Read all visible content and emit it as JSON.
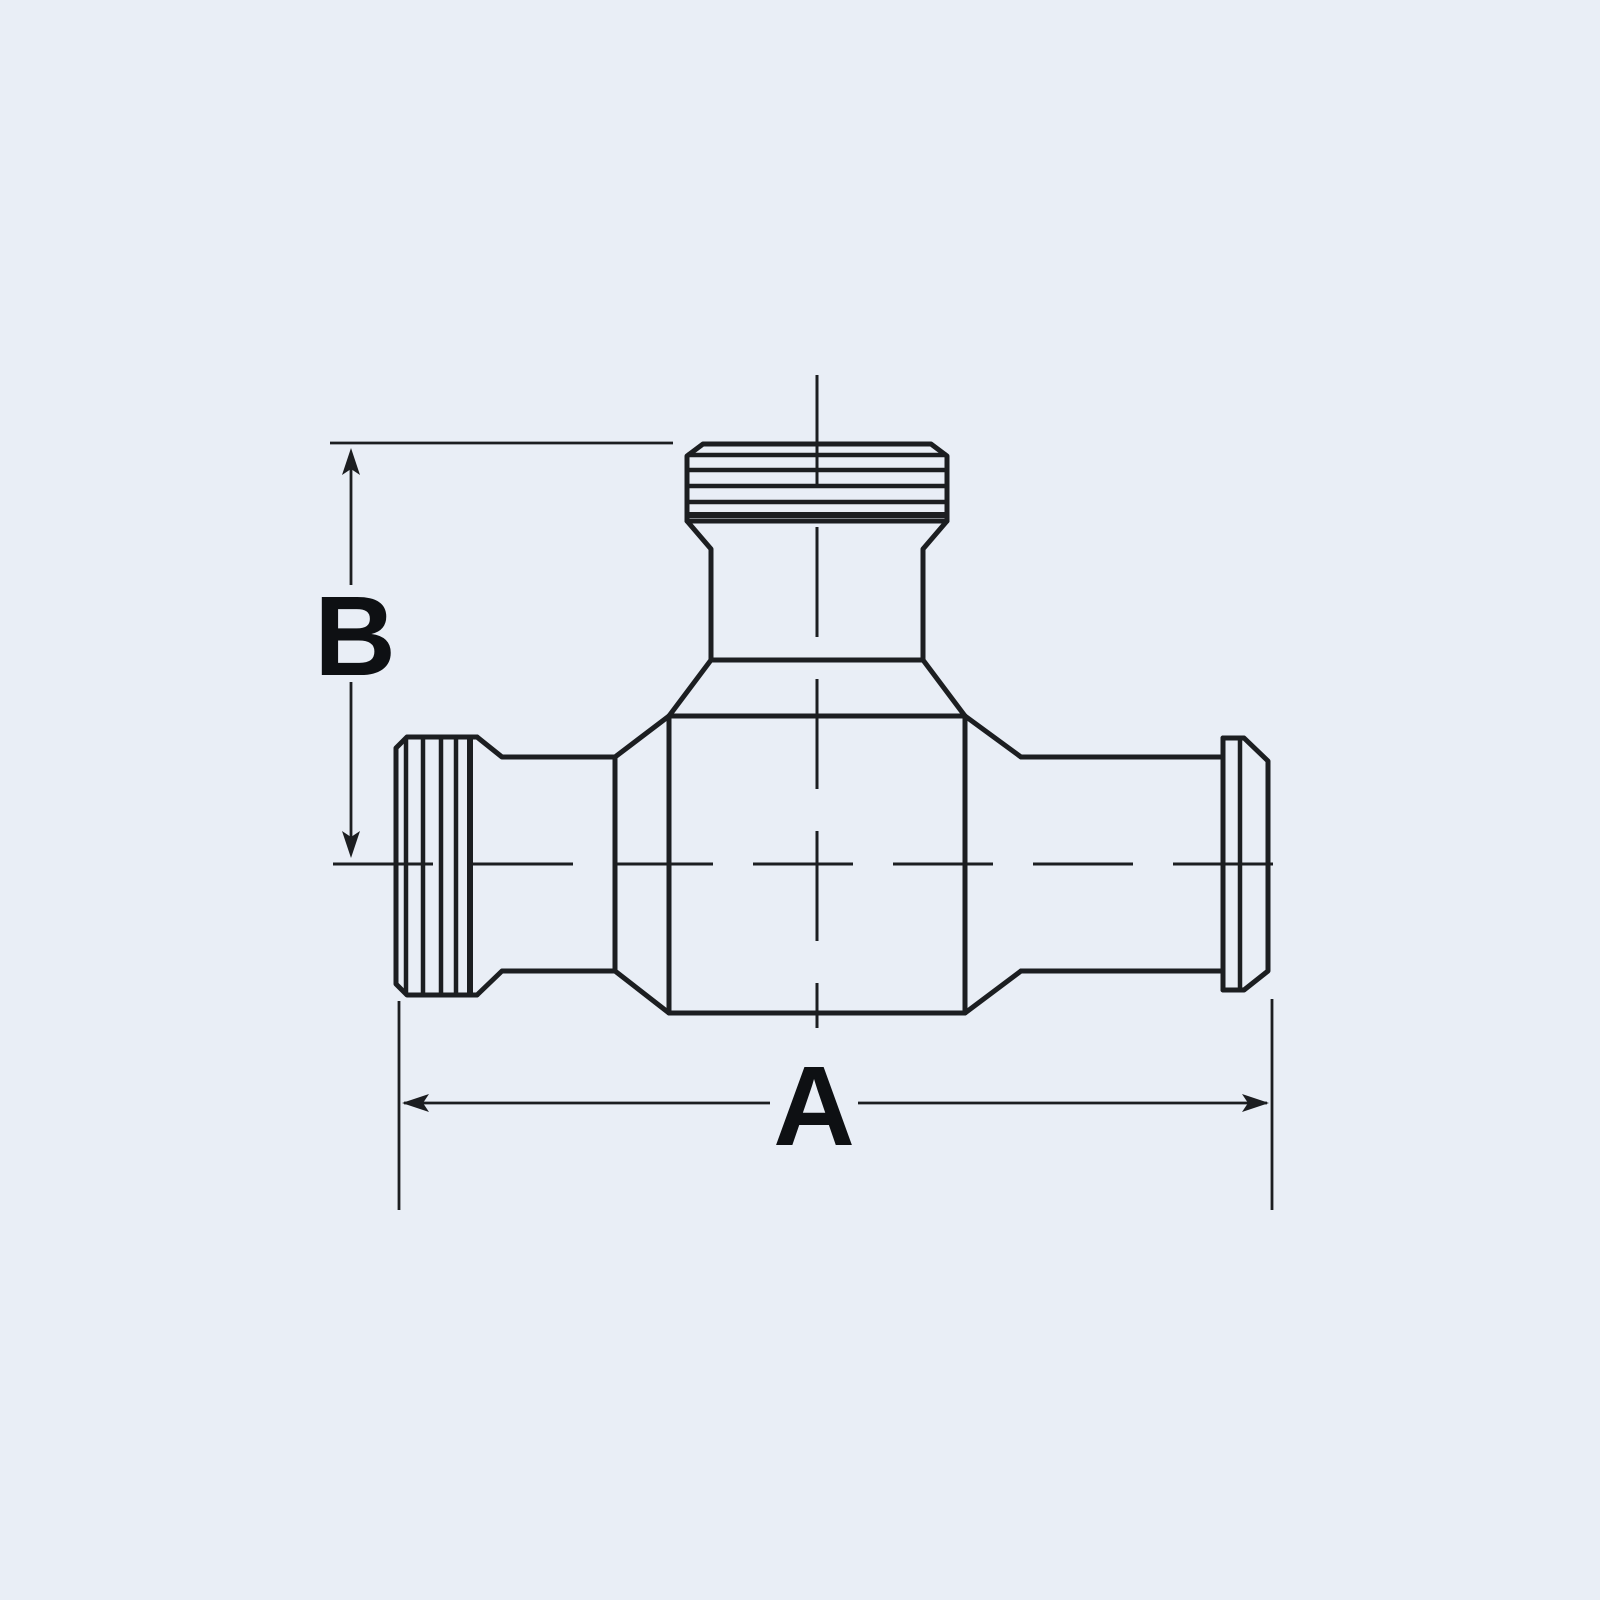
{
  "diagram": {
    "type": "technical-drawing",
    "subject": "pipe-tee-fitting-side-view",
    "dimensions": {
      "a_label": "A",
      "b_label": "B"
    },
    "colors": {
      "background": "#e9eef6",
      "line": "#1c1e21",
      "label": "#0e1013"
    }
  }
}
